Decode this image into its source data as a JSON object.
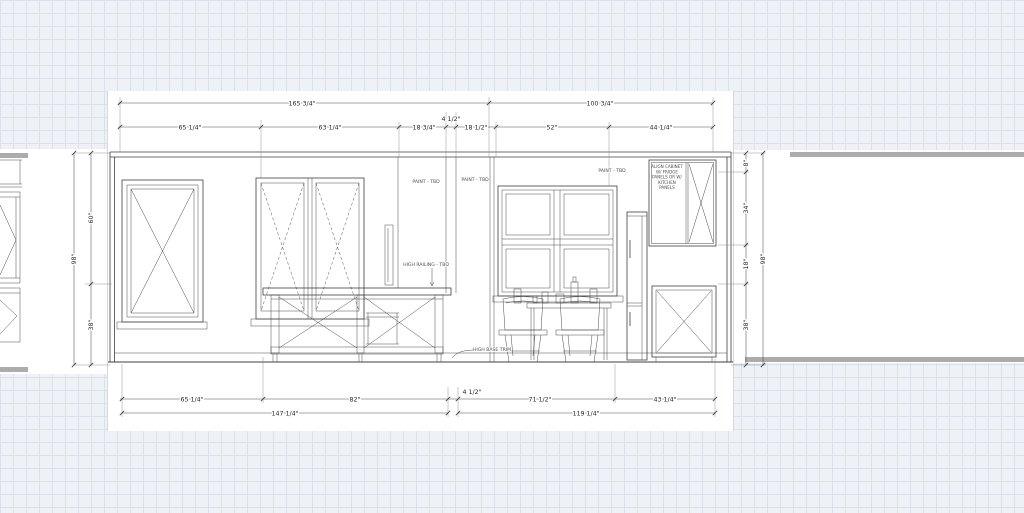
{
  "drawing": {
    "dims": {
      "top1": [
        "165 3/4\"",
        "100 3/4\""
      ],
      "top2": [
        "65 1/4\"",
        "63 1/4\"",
        "18 3/4\"",
        "4 1/2\"",
        "18 1/2\"",
        "52\"",
        "44 1/4\""
      ],
      "bottom1": [
        "65 1/4\"",
        "82\"",
        "4 1/2\"",
        "71 1/2\"",
        "43 1/4\""
      ],
      "bottom2": [
        "147 1/4\"",
        "119 1/4\""
      ],
      "left": {
        "overall": "98\"",
        "upper": "60\"",
        "lower": "38\""
      },
      "right": {
        "overall": "98\"",
        "top": "8\"",
        "upper": "34\"",
        "middle": "18\"",
        "lower": "38\""
      }
    },
    "notes": {
      "paint": "PAINT - TBD",
      "high_railing": "HIGH RAILING - TBD",
      "high_base_trim": "HIGH BASE TRIM",
      "cabinet_note": [
        "ALIGN CABINET",
        "W/ FRIDGE",
        "PANELS OR W/",
        "KITCHEN",
        "PANELS"
      ]
    },
    "colors": {
      "linework": "#3f3f3f",
      "dimension": "#4f4f4f",
      "sheet": "#ffffff",
      "grid_bg": "#eef1f5",
      "grid_line": "#dbe0e9",
      "gray_band": "#acacac"
    }
  }
}
